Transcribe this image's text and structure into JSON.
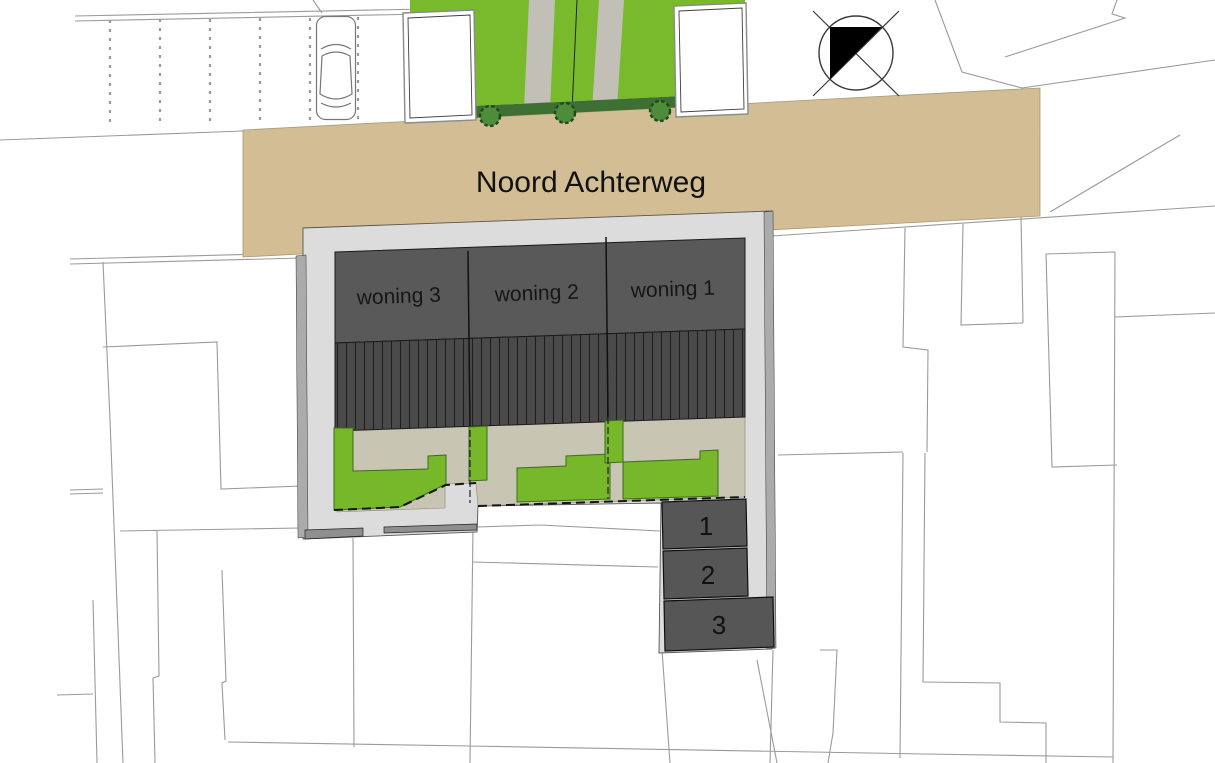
{
  "road": {
    "name": "Noord Achterweg"
  },
  "houses": [
    {
      "label": "woning 3"
    },
    {
      "label": "woning 2"
    },
    {
      "label": "woning 1"
    }
  ],
  "parking_spaces": [
    {
      "label": "1"
    },
    {
      "label": "2"
    },
    {
      "label": "3"
    }
  ],
  "icons": {
    "north_arrow": "north-arrow",
    "car": "car-top-view",
    "tree": "tree"
  },
  "colors": {
    "road": "#d2bd94",
    "plot": "#dcdcdc",
    "plot_edge": "#ababab",
    "wall": "#8f8f8f",
    "house_band": "#595959",
    "roof": "#4a4a4a",
    "terrace": "#c9c5b3",
    "garden": "#76b82a",
    "lawn": "#79ba2d",
    "hedge": "#3e6f33",
    "tree": "#4e8c3c",
    "path_gray": "#c2c0b6",
    "parking": "#565656",
    "parcel_line": "#9a9a9a",
    "text": "#111111"
  }
}
